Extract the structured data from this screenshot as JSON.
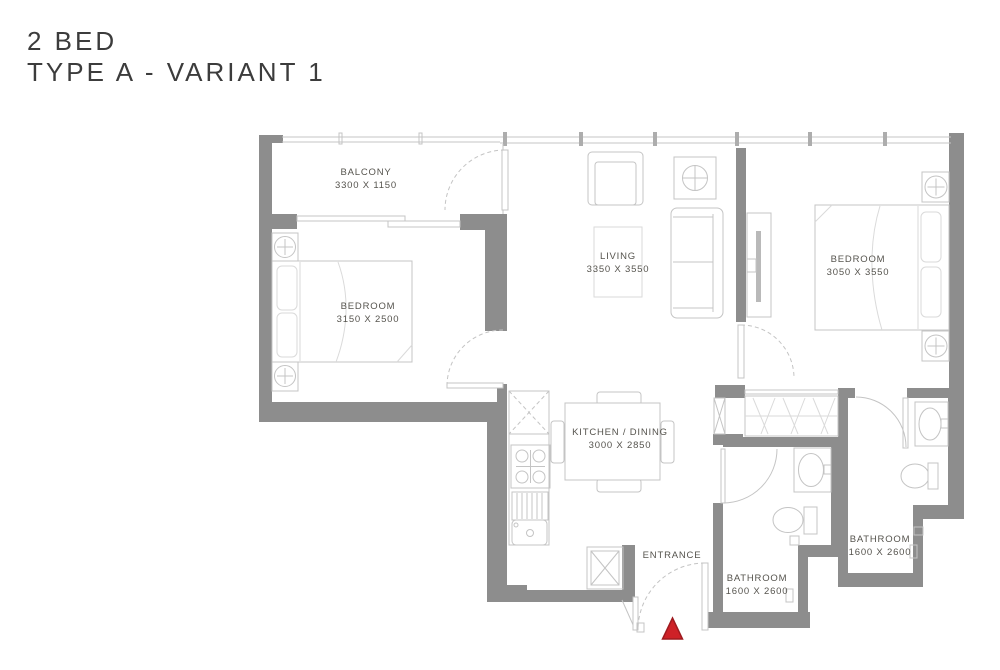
{
  "title": {
    "line1": "2 BED",
    "line2": "TYPE A - VARIANT 1"
  },
  "rooms": [
    {
      "id": "balcony",
      "name": "BALCONY",
      "dims": "3300 X 1150"
    },
    {
      "id": "bedroom-1",
      "name": "BEDROOM",
      "dims": "3150 X 2500"
    },
    {
      "id": "living",
      "name": "LIVING",
      "dims": "3350 X 3550"
    },
    {
      "id": "bedroom-2",
      "name": "BEDROOM",
      "dims": "3050 X 3550"
    },
    {
      "id": "kitchen-dining",
      "name": "KITCHEN / DINING",
      "dims": "3000 X 2850"
    },
    {
      "id": "bathroom-1",
      "name": "BATHROOM",
      "dims": "1600 X 2600"
    },
    {
      "id": "bathroom-2",
      "name": "BATHROOM",
      "dims": "1600 X 2600"
    }
  ],
  "entrance": {
    "label": "ENTRANCE"
  },
  "colors": {
    "wall": "#8d8d8d",
    "furniture": "#c4c4c4",
    "furniture_light": "#dadada",
    "label": "#56544e",
    "title": "#3c3c3c",
    "entrance_marker": "#ce2127",
    "entrance_marker_border": "#9e1a1f"
  }
}
